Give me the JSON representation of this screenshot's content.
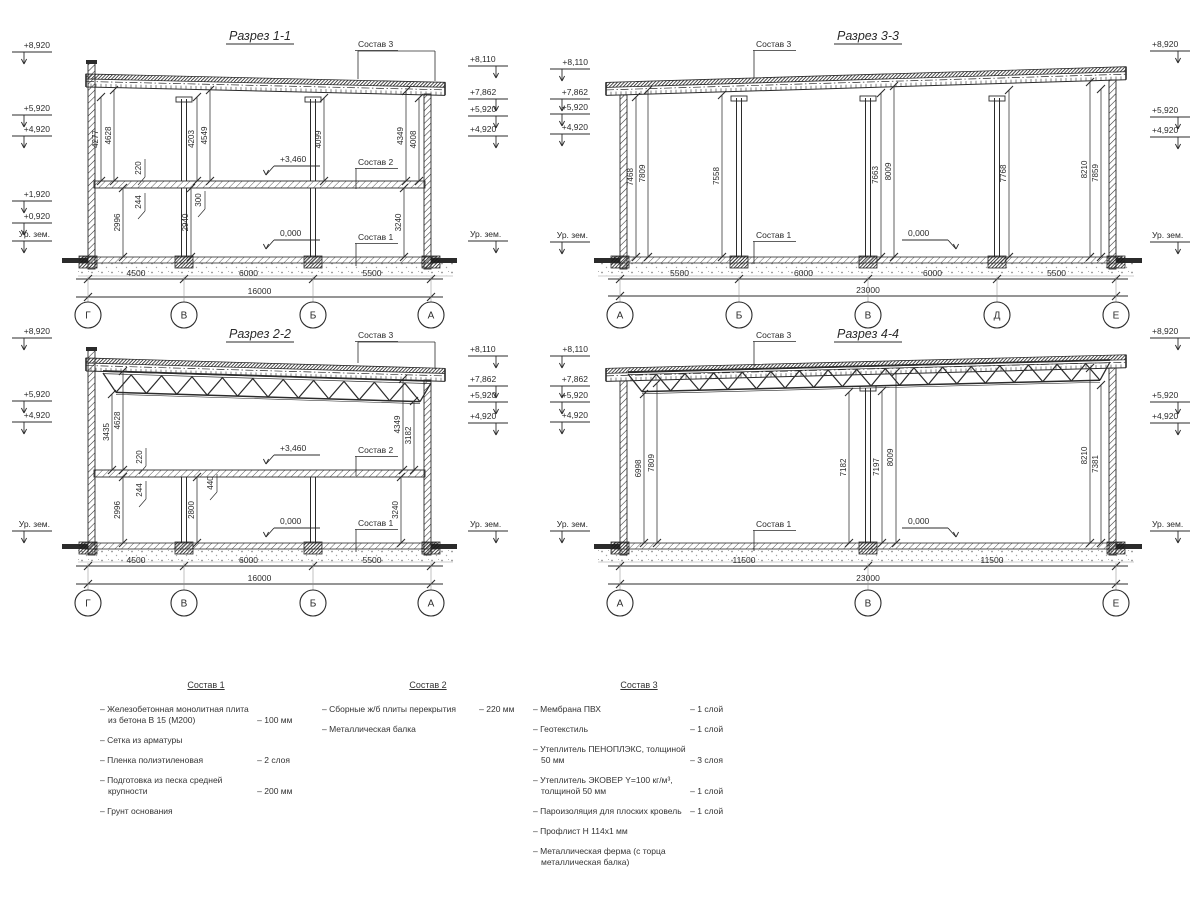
{
  "sheet": {
    "bg": "#ffffff",
    "ink": "#2b2b2b",
    "faint": "#8c8c8c"
  },
  "sections": [
    {
      "id": "1-1",
      "title": {
        "t": "Разрез 1-1",
        "x": 260,
        "y": 40
      },
      "geom": {
        "xL": 88,
        "xR": 431,
        "roofYL": 74,
        "roofYR": 82,
        "wallTopL": 63,
        "wallTopR": 94,
        "overL": 2,
        "overR": 14,
        "midY": 181,
        "floorY": 257,
        "dimY1": 279,
        "dimY2": 297,
        "axisY": 315,
        "markL": 12,
        "markR": 468,
        "cols": [
          {
            "xs": [
              184,
              313
            ],
            "y1": 99,
            "y2": 181,
            "cap": 1
          },
          {
            "xs": [
              184,
              313
            ],
            "y1": 188,
            "y2": 257,
            "cap": 0
          }
        ],
        "truss": null
      },
      "axes": [
        {
          "t": "Г",
          "x": 88
        },
        {
          "t": "В",
          "x": 184
        },
        {
          "t": "Б",
          "x": 313
        },
        {
          "t": "А",
          "x": 431
        }
      ],
      "hdims": [
        {
          "t": "4500",
          "x1": 88,
          "x2": 184
        },
        {
          "t": "6000",
          "x1": 184,
          "x2": 313
        },
        {
          "t": "5500",
          "x1": 313,
          "x2": 431
        }
      ],
      "total": "16000",
      "elevL": [
        {
          "t": "+8,920",
          "y": 45
        },
        {
          "t": "+5,920",
          "y": 108
        },
        {
          "t": "+4,920",
          "y": 129
        },
        {
          "t": "+1,920",
          "y": 194
        },
        {
          "t": "+0,920",
          "y": 216
        },
        {
          "t": "Ур. зем.",
          "y": 234
        }
      ],
      "elevR": [
        {
          "t": "+8,110",
          "y": 59
        },
        {
          "t": "+7,862",
          "y": 92
        },
        {
          "t": "+5,920",
          "y": 109
        },
        {
          "t": "+4,920",
          "y": 129
        },
        {
          "t": "Ур. зем.",
          "y": 234
        }
      ],
      "vdims": [
        {
          "t": "4277",
          "x": 101,
          "y1": 97,
          "y2": 181
        },
        {
          "t": "4628",
          "x": 114,
          "y1": 90,
          "y2": 181
        },
        {
          "t": "4203",
          "x": 197,
          "y1": 97,
          "y2": 181
        },
        {
          "t": "4549",
          "x": 210,
          "y1": 90,
          "y2": 181
        },
        {
          "t": "4099",
          "x": 324,
          "y1": 98,
          "y2": 181
        },
        {
          "t": "4349",
          "x": 406,
          "y1": 91,
          "y2": 181
        },
        {
          "t": "4008",
          "x": 419,
          "y1": 98,
          "y2": 181
        },
        {
          "t": "2996",
          "x": 123,
          "y1": 188,
          "y2": 257
        },
        {
          "t": "2940",
          "x": 191,
          "y1": 188,
          "y2": 257
        },
        {
          "t": "3240",
          "x": 404,
          "y1": 188,
          "y2": 257
        }
      ],
      "callouts": [
        {
          "t": "220",
          "x": 141,
          "y": 168
        },
        {
          "t": "244",
          "x": 141,
          "y": 202
        },
        {
          "t": "300",
          "x": 201,
          "y": 200
        }
      ],
      "levels": [
        {
          "t": "+3,460",
          "x": 280,
          "y": 159,
          "a": -1
        },
        {
          "t": "0,000",
          "x": 280,
          "y": 233,
          "a": -1
        }
      ],
      "materials": [
        {
          "t": "Состав 3",
          "x": 358,
          "y": 44,
          "legs": [
            [
              358,
              51,
              79
            ],
            [
              435,
              51,
              81
            ]
          ],
          "bar": [
            358,
            435,
            51
          ]
        },
        {
          "t": "Состав 2",
          "x": 358,
          "y": 162,
          "legs": [
            [
              356,
              168.5,
              189
            ]
          ],
          "bar": null
        },
        {
          "t": "Состав 1",
          "x": 358,
          "y": 237,
          "legs": [
            [
              356,
              243.5,
              266
            ]
          ],
          "bar": null
        }
      ]
    },
    {
      "id": "2-2",
      "title": {
        "t": "Разрез 2-2",
        "x": 260,
        "y": 338
      },
      "geom": {
        "xL": 88,
        "xR": 431,
        "roofYL": 358,
        "roofYR": 368,
        "wallTopL": 350,
        "wallTopR": 380,
        "overL": 2,
        "overR": 14,
        "midY": 470,
        "floorY": 543,
        "dimY1": 566,
        "dimY2": 584,
        "axisY": 603,
        "markL": 12,
        "markR": 468,
        "cols": [
          {
            "xs": [
              184,
              313
            ],
            "y1": 477,
            "y2": 543,
            "cap": 0
          }
        ],
        "truss": {
          "x1": 103,
          "y1": 371,
          "x2": 431,
          "y2": 381,
          "bx1": 116,
          "bx2": 420,
          "drop": 21,
          "n": 10
        }
      },
      "axes": [
        {
          "t": "Г",
          "x": 88
        },
        {
          "t": "В",
          "x": 184
        },
        {
          "t": "Б",
          "x": 313
        },
        {
          "t": "А",
          "x": 431
        }
      ],
      "hdims": [
        {
          "t": "4500",
          "x1": 88,
          "x2": 184
        },
        {
          "t": "6000",
          "x1": 184,
          "x2": 313
        },
        {
          "t": "5500",
          "x1": 313,
          "x2": 431
        }
      ],
      "total": "16000",
      "elevL": [
        {
          "t": "+8,920",
          "y": 331
        },
        {
          "t": "+5,920",
          "y": 394
        },
        {
          "t": "+4,920",
          "y": 415
        },
        {
          "t": "Ур. зем.",
          "y": 524
        }
      ],
      "elevR": [
        {
          "t": "+8,110",
          "y": 349
        },
        {
          "t": "+7,862",
          "y": 379
        },
        {
          "t": "+5,920",
          "y": 395
        },
        {
          "t": "+4,920",
          "y": 416
        },
        {
          "t": "Ур. зем.",
          "y": 524
        }
      ],
      "vdims": [
        {
          "t": "3435",
          "x": 112,
          "y1": 394,
          "y2": 470
        },
        {
          "t": "4628",
          "x": 123,
          "y1": 371,
          "y2": 470
        },
        {
          "t": "4349",
          "x": 403,
          "y1": 379,
          "y2": 470
        },
        {
          "t": "3182",
          "x": 414,
          "y1": 401,
          "y2": 470
        },
        {
          "t": "2996",
          "x": 123,
          "y1": 477,
          "y2": 543
        },
        {
          "t": "2800",
          "x": 197,
          "y1": 477,
          "y2": 543
        },
        {
          "t": "3240",
          "x": 401,
          "y1": 477,
          "y2": 543
        }
      ],
      "callouts": [
        {
          "t": "220",
          "x": 142,
          "y": 457
        },
        {
          "t": "244",
          "x": 142,
          "y": 490
        },
        {
          "t": "440",
          "x": 213,
          "y": 483
        }
      ],
      "levels": [
        {
          "t": "+3,460",
          "x": 280,
          "y": 448,
          "a": -1
        },
        {
          "t": "0,000",
          "x": 280,
          "y": 521,
          "a": -1
        }
      ],
      "materials": [
        {
          "t": "Состав 3",
          "x": 358,
          "y": 335,
          "legs": [
            [
              358,
              342,
              363
            ],
            [
              435,
              342,
              369
            ]
          ],
          "bar": [
            358,
            435,
            342
          ]
        },
        {
          "t": "Состав 2",
          "x": 358,
          "y": 450,
          "legs": [
            [
              356,
              456.5,
              476
            ]
          ],
          "bar": null
        },
        {
          "t": "Состав 1",
          "x": 358,
          "y": 523,
          "legs": [
            [
              356,
              529.5,
              552
            ]
          ],
          "bar": null
        }
      ]
    },
    {
      "id": "3-3",
      "title": {
        "t": "Разрез 3-3",
        "x": 868,
        "y": 40
      },
      "geom": {
        "xL": 620,
        "xR": 1116,
        "roofYL": 82,
        "roofYR": 67,
        "wallTopL": 95,
        "wallTopR": 80,
        "overL": 14,
        "overR": 10,
        "midY": null,
        "floorY": 257,
        "dimY1": 279,
        "dimY2": 296,
        "axisY": 315,
        "markL": 550,
        "markR": 1150,
        "cols": [
          {
            "xs": [
              739,
              868,
              997
            ],
            "y1": 98,
            "y2": 257,
            "cap": 1
          }
        ],
        "truss": null
      },
      "axes": [
        {
          "t": "А",
          "x": 620
        },
        {
          "t": "Б",
          "x": 739
        },
        {
          "t": "В",
          "x": 868
        },
        {
          "t": "Д",
          "x": 997
        },
        {
          "t": "Е",
          "x": 1116
        }
      ],
      "hdims": [
        {
          "t": "5500",
          "x1": 620,
          "x2": 739
        },
        {
          "t": "6000",
          "x1": 739,
          "x2": 868
        },
        {
          "t": "6000",
          "x1": 868,
          "x2": 997
        },
        {
          "t": "5500",
          "x1": 997,
          "x2": 1116
        }
      ],
      "total": "23000",
      "elevL": [
        {
          "t": "+8,110",
          "y": 62
        },
        {
          "t": "+7,862",
          "y": 92
        },
        {
          "t": "+5,920",
          "y": 107
        },
        {
          "t": "+4,920",
          "y": 127
        },
        {
          "t": "Ур. зем.",
          "y": 235
        }
      ],
      "elevR": [
        {
          "t": "+8,920",
          "y": 44
        },
        {
          "t": "+5,920",
          "y": 110
        },
        {
          "t": "+4,920",
          "y": 130
        },
        {
          "t": "Ур. зем.",
          "y": 235
        }
      ],
      "vdims": [
        {
          "t": "7468",
          "x": 636,
          "y1": 97,
          "y2": 257
        },
        {
          "t": "7809",
          "x": 648,
          "y1": 90,
          "y2": 257
        },
        {
          "t": "7558",
          "x": 722,
          "y1": 95,
          "y2": 257
        },
        {
          "t": "7663",
          "x": 881,
          "y1": 93,
          "y2": 257
        },
        {
          "t": "8009",
          "x": 894,
          "y1": 86,
          "y2": 257
        },
        {
          "t": "7768",
          "x": 1009,
          "y1": 90,
          "y2": 257
        },
        {
          "t": "8210",
          "x": 1090,
          "y1": 82,
          "y2": 257
        },
        {
          "t": "7859",
          "x": 1101,
          "y1": 89,
          "y2": 257
        }
      ],
      "callouts": [],
      "levels": [
        {
          "t": "0,000",
          "x": 908,
          "y": 233,
          "a": 1
        }
      ],
      "materials": [
        {
          "t": "Состав 3",
          "x": 756,
          "y": 44,
          "legs": [
            [
              754,
              50.5,
              78
            ]
          ],
          "bar": null
        },
        {
          "t": "Состав 1",
          "x": 756,
          "y": 235,
          "legs": [
            [
              754,
              241.5,
              264
            ]
          ],
          "bar": null
        }
      ]
    },
    {
      "id": "4-4",
      "title": {
        "t": "Разрез 4-4",
        "x": 868,
        "y": 338
      },
      "geom": {
        "xL": 620,
        "xR": 1116,
        "roofYL": 368,
        "roofYR": 355,
        "wallTopL": 381,
        "wallTopR": 368,
        "overL": 14,
        "overR": 10,
        "midY": null,
        "floorY": 543,
        "dimY1": 566,
        "dimY2": 584,
        "axisY": 603,
        "markL": 550,
        "markR": 1150,
        "cols": [
          {
            "xs": [
              868
            ],
            "y1": 388,
            "y2": 543,
            "cap": 1
          }
        ],
        "truss": {
          "x1": 628,
          "y1": 372,
          "x2": 1110,
          "y2": 360,
          "bx1": 642,
          "bx2": 1100,
          "drop": 20,
          "n": 16
        }
      },
      "axes": [
        {
          "t": "А",
          "x": 620
        },
        {
          "t": "В",
          "x": 868
        },
        {
          "t": "Е",
          "x": 1116
        }
      ],
      "hdims": [
        {
          "t": "11500",
          "x1": 620,
          "x2": 868
        },
        {
          "t": "11500",
          "x1": 868,
          "x2": 1116
        }
      ],
      "total": "23000",
      "elevL": [
        {
          "t": "+8,110",
          "y": 349
        },
        {
          "t": "+7,862",
          "y": 379
        },
        {
          "t": "+5,920",
          "y": 395
        },
        {
          "t": "+4,920",
          "y": 415
        },
        {
          "t": "Ур. зем.",
          "y": 524
        }
      ],
      "elevR": [
        {
          "t": "+8,920",
          "y": 331
        },
        {
          "t": "+5,920",
          "y": 395
        },
        {
          "t": "+4,920",
          "y": 416
        },
        {
          "t": "Ур. зем.",
          "y": 524
        }
      ],
      "vdims": [
        {
          "t": "6998",
          "x": 644,
          "y1": 394,
          "y2": 543
        },
        {
          "t": "7809",
          "x": 657,
          "y1": 383,
          "y2": 543
        },
        {
          "t": "7182",
          "x": 849,
          "y1": 392,
          "y2": 543
        },
        {
          "t": "7197",
          "x": 882,
          "y1": 391,
          "y2": 543
        },
        {
          "t": "8009",
          "x": 896,
          "y1": 372,
          "y2": 543
        },
        {
          "t": "8210",
          "x": 1090,
          "y1": 368,
          "y2": 543
        },
        {
          "t": "7381",
          "x": 1101,
          "y1": 385,
          "y2": 543
        }
      ],
      "callouts": [],
      "levels": [
        {
          "t": "0,000",
          "x": 908,
          "y": 521,
          "a": 1
        }
      ],
      "materials": [
        {
          "t": "Состав 3",
          "x": 756,
          "y": 335,
          "legs": [
            [
              754,
              341.5,
              366
            ]
          ],
          "bar": null
        },
        {
          "t": "Состав 1",
          "x": 756,
          "y": 524,
          "legs": [
            [
              754,
              530.5,
              551
            ]
          ],
          "bar": null
        }
      ]
    }
  ],
  "legend": {
    "columns": [
      {
        "title": "Состав 1",
        "x": 100,
        "y": 680,
        "items": [
          {
            "label": "– Железобетонная  монолитная плита из бетона В 15 (М200)",
            "value": "– 100 мм"
          },
          {
            "label": "– Сетка из арматуры",
            "value": ""
          },
          {
            "label": "– Пленка полиэтиленовая",
            "value": "–  2 слоя"
          },
          {
            "label": "– Подготовка из песка средней крупности",
            "value": "– 200 мм"
          },
          {
            "label": "– Грунт основания",
            "value": ""
          }
        ]
      },
      {
        "title": "Состав 2",
        "x": 322,
        "y": 680,
        "items": [
          {
            "label": "– Сборные ж/б плиты перекрытия",
            "value": "– 220 мм"
          },
          {
            "label": "– Металлическая балка",
            "value": ""
          }
        ]
      },
      {
        "title": "Состав 3",
        "x": 533,
        "y": 680,
        "items": [
          {
            "label": "– Мембрана ПВХ",
            "value": "– 1 слой"
          },
          {
            "label": "– Геотекстиль",
            "value": "– 1 слой"
          },
          {
            "label": "– Утеплитель ПЕНОПЛЭКС, толщиной 50 мм",
            "value": "– 3 слоя"
          },
          {
            "label": "– Утеплитель ЭКОВЕР Y=100 кг/м³, толщиной 50 мм",
            "value": "– 1 слой"
          },
          {
            "label": "– Пароизоляция для плоских кровель",
            "value": "– 1 слой"
          },
          {
            "label": "– Профлист Н 114х1 мм",
            "value": ""
          },
          {
            "label": "– Металлическая ферма (с торца металлическая балка)",
            "value": ""
          }
        ]
      }
    ]
  }
}
